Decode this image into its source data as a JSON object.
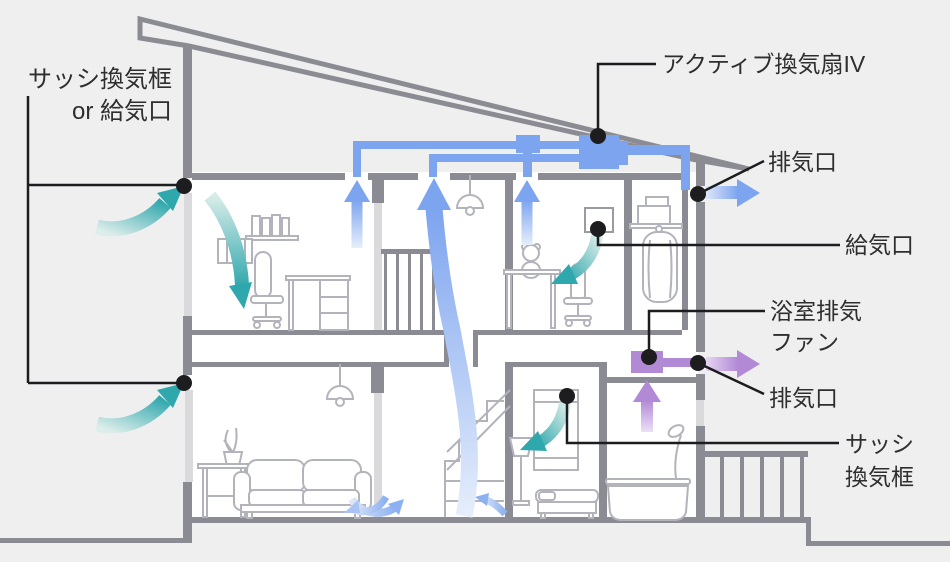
{
  "diagram": {
    "type": "house-ventilation-cross-section",
    "background": "#efeff0",
    "colors": {
      "wall_gray": "#8b8b93",
      "furniture_gray": "#b3b3bb",
      "window_light": "#dadadd",
      "duct_blue": "#7da4ef",
      "fresh_teal": "#2fa8ad",
      "exhaust_purple": "#b289d5",
      "line_black": "#1d1d1f",
      "text_dark": "#2e2e2e",
      "interior_white": "#ffffff"
    },
    "labels": {
      "sash_vent_or_supply_line1": "サッシ換気框",
      "sash_vent_or_supply_line2": "or 給気口",
      "active_fan": "アクティブ換気扇IV",
      "exhaust_top": "排気口",
      "supply_port": "給気口",
      "bath_fan_line1": "浴室排気",
      "bath_fan_line2": "ファン",
      "exhaust_bottom": "排気口",
      "sash_vent_line1": "サッシ",
      "sash_vent_line2": "換気框"
    },
    "icons": [
      "active-ventilation-fan-icon",
      "duct-junction-icon",
      "bathroom-exhaust-fan-icon",
      "fresh-air-arrow-icon",
      "supply-air-arrow-icon",
      "exhaust-air-arrow-icon",
      "callout-dot-icon"
    ]
  }
}
